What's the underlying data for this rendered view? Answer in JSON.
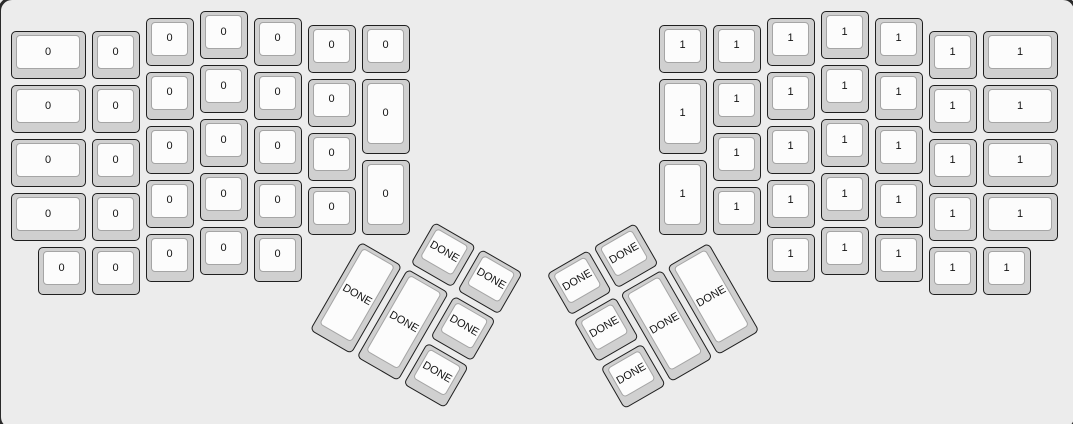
{
  "canvas": {
    "width": 1073,
    "height": 424,
    "background": "#ececec",
    "frame_border_color": "#2a2a2a"
  },
  "colors": {
    "page_bg": "#ececec",
    "cap_base": "#d0d0d0",
    "cap_border": "#1f1f1f",
    "cap_top": "#fcfcfc",
    "cap_top_border": "#a5a5a5",
    "label_color": "#141414"
  },
  "keyboard": {
    "type": "ergodox-split",
    "unit": 54,
    "origin": {
      "x": 9,
      "y": 9
    },
    "groups": [
      {
        "name": "left-hand-keys",
        "label": "0",
        "rotation": 0,
        "rx": 0,
        "ry": 0,
        "keys": [
          {
            "x": 0,
            "y": 0.375,
            "w": 1.5
          },
          {
            "x": 1.5,
            "y": 0.375
          },
          {
            "x": 2.5,
            "y": 0.125
          },
          {
            "x": 3.5,
            "y": 0
          },
          {
            "x": 4.5,
            "y": 0.125
          },
          {
            "x": 5.5,
            "y": 0.25
          },
          {
            "x": 6.5,
            "y": 0.25
          },
          {
            "x": 0,
            "y": 1.375,
            "w": 1.5
          },
          {
            "x": 1.5,
            "y": 1.375
          },
          {
            "x": 2.5,
            "y": 1.125
          },
          {
            "x": 3.5,
            "y": 1
          },
          {
            "x": 4.5,
            "y": 1.125
          },
          {
            "x": 5.5,
            "y": 1.25
          },
          {
            "x": 6.5,
            "y": 1.25,
            "h": 1.5
          },
          {
            "x": 0,
            "y": 2.375,
            "w": 1.5
          },
          {
            "x": 1.5,
            "y": 2.375
          },
          {
            "x": 2.5,
            "y": 2.125
          },
          {
            "x": 3.5,
            "y": 2
          },
          {
            "x": 4.5,
            "y": 2.125
          },
          {
            "x": 5.5,
            "y": 2.25
          },
          {
            "x": 6.5,
            "y": 2.75,
            "h": 1.5
          },
          {
            "x": 0,
            "y": 3.375,
            "w": 1.5
          },
          {
            "x": 1.5,
            "y": 3.375
          },
          {
            "x": 2.5,
            "y": 3.125
          },
          {
            "x": 3.5,
            "y": 3
          },
          {
            "x": 4.5,
            "y": 3.125
          },
          {
            "x": 5.5,
            "y": 3.25
          },
          {
            "x": 0.5,
            "y": 4.375
          },
          {
            "x": 1.5,
            "y": 4.375
          },
          {
            "x": 2.5,
            "y": 4.125
          },
          {
            "x": 3.5,
            "y": 4
          },
          {
            "x": 4.5,
            "y": 4.125
          }
        ]
      },
      {
        "name": "right-hand-keys",
        "label": "1",
        "rotation": 0,
        "rx": 0,
        "ry": 0,
        "keys": [
          {
            "x": 12,
            "y": 0.25
          },
          {
            "x": 13,
            "y": 0.25
          },
          {
            "x": 14,
            "y": 0.125
          },
          {
            "x": 15,
            "y": 0
          },
          {
            "x": 16,
            "y": 0.125
          },
          {
            "x": 17,
            "y": 0.375
          },
          {
            "x": 18,
            "y": 0.375,
            "w": 1.5
          },
          {
            "x": 12,
            "y": 1.25,
            "h": 1.5
          },
          {
            "x": 13,
            "y": 1.25
          },
          {
            "x": 14,
            "y": 1.125
          },
          {
            "x": 15,
            "y": 1
          },
          {
            "x": 16,
            "y": 1.125
          },
          {
            "x": 17,
            "y": 1.375
          },
          {
            "x": 18,
            "y": 1.375,
            "w": 1.5
          },
          {
            "x": 12,
            "y": 2.75,
            "h": 1.5
          },
          {
            "x": 13,
            "y": 2.25
          },
          {
            "x": 14,
            "y": 2.125
          },
          {
            "x": 15,
            "y": 2
          },
          {
            "x": 16,
            "y": 2.125
          },
          {
            "x": 17,
            "y": 2.375
          },
          {
            "x": 18,
            "y": 2.375,
            "w": 1.5
          },
          {
            "x": 13,
            "y": 3.25
          },
          {
            "x": 14,
            "y": 3.125
          },
          {
            "x": 15,
            "y": 3
          },
          {
            "x": 16,
            "y": 3.125
          },
          {
            "x": 17,
            "y": 3.375
          },
          {
            "x": 18,
            "y": 3.375,
            "w": 1.5
          },
          {
            "x": 14,
            "y": 4.125
          },
          {
            "x": 15,
            "y": 4
          },
          {
            "x": 16,
            "y": 4.125
          },
          {
            "x": 17,
            "y": 4.375
          },
          {
            "x": 18,
            "y": 4.375
          }
        ]
      },
      {
        "name": "left-thumb-cluster",
        "label": "DONE",
        "rotation": 30,
        "rx": 6.5,
        "ry": 4.25,
        "keys": [
          {
            "x": 1,
            "y": -1
          },
          {
            "x": 2,
            "y": -1
          },
          {
            "x": 0,
            "y": 0,
            "h": 2
          },
          {
            "x": 1,
            "y": 0,
            "h": 2
          },
          {
            "x": 2,
            "y": 0
          },
          {
            "x": 2,
            "y": 1
          }
        ]
      },
      {
        "name": "right-thumb-cluster",
        "label": "DONE",
        "rotation": -30,
        "rx": 13,
        "ry": 4.25,
        "keys": [
          {
            "x": -3,
            "y": -1
          },
          {
            "x": -2,
            "y": -1
          },
          {
            "x": -3,
            "y": 0
          },
          {
            "x": -2,
            "y": 0,
            "h": 2
          },
          {
            "x": -1,
            "y": 0,
            "h": 2
          },
          {
            "x": -3,
            "y": 1
          }
        ]
      }
    ]
  }
}
